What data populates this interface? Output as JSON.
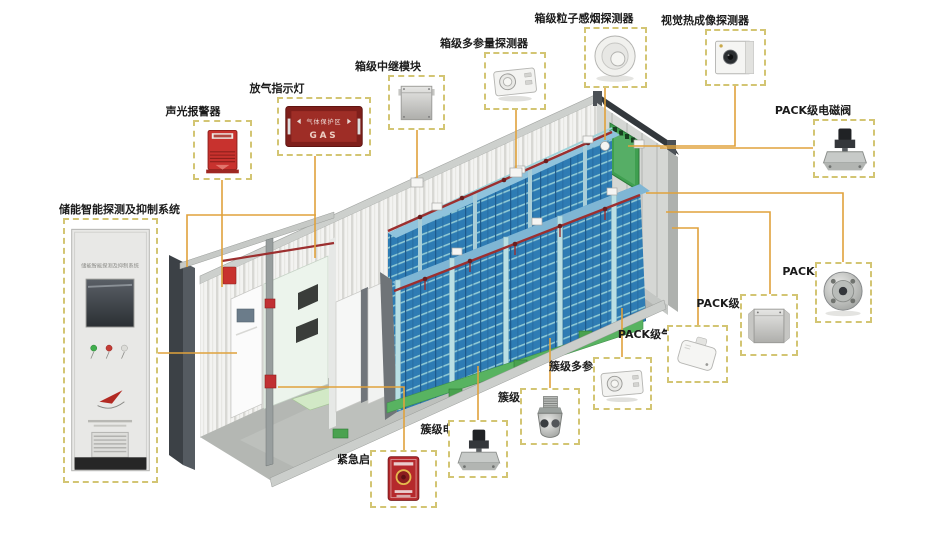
{
  "diagram_subject": "储能集装箱消防探测与抑制系统示意图",
  "colors": {
    "connector_line": "#e0a23c",
    "dashed_box_border": "#d3c573",
    "battery_blue": "#2e7cb4",
    "rack_frame_teal": "#b9dfe4",
    "rack_base_green": "#58b361",
    "pipe_red": "#9c2f2f",
    "end_door_green": "#3f9f50",
    "alarm_red": "#c8322e",
    "container_wall": "#f3f3f1"
  },
  "components": {
    "system_cabinet": {
      "label": "储能智能探测及抑制系统",
      "panel_text": "储能智能探测及抑制系统"
    },
    "sound_light_alarm": {
      "label": "声光报警器"
    },
    "gas_release_indicator": {
      "label": "放气指示灯",
      "sign_line1": "气体保护区",
      "sign_line2": "GAS"
    },
    "box_relay_module": {
      "label": "箱级中继模块"
    },
    "box_multi_param_detector": {
      "label": "箱级多参量探测器"
    },
    "box_smoke_detector": {
      "label": "箱级粒子感烟探测器"
    },
    "thermal_imaging_detector": {
      "label": "视觉热成像探测器"
    },
    "pack_solenoid_valve": {
      "label": "PACK级电磁阀"
    },
    "pack_nozzle": {
      "label": "PACK级喷头"
    },
    "pack_relay_module": {
      "label": "PACK级中继模块"
    },
    "pack_gas_detector": {
      "label": "PACK级气体探测器"
    },
    "cluster_multi_param_detector": {
      "label": "簇级多参量探测器"
    },
    "cluster_nozzle": {
      "label": "簇级喷头"
    },
    "cluster_solenoid_valve": {
      "label": "簇级电磁阀"
    },
    "emergency_start_button": {
      "label": "紧急启动按钮"
    }
  }
}
